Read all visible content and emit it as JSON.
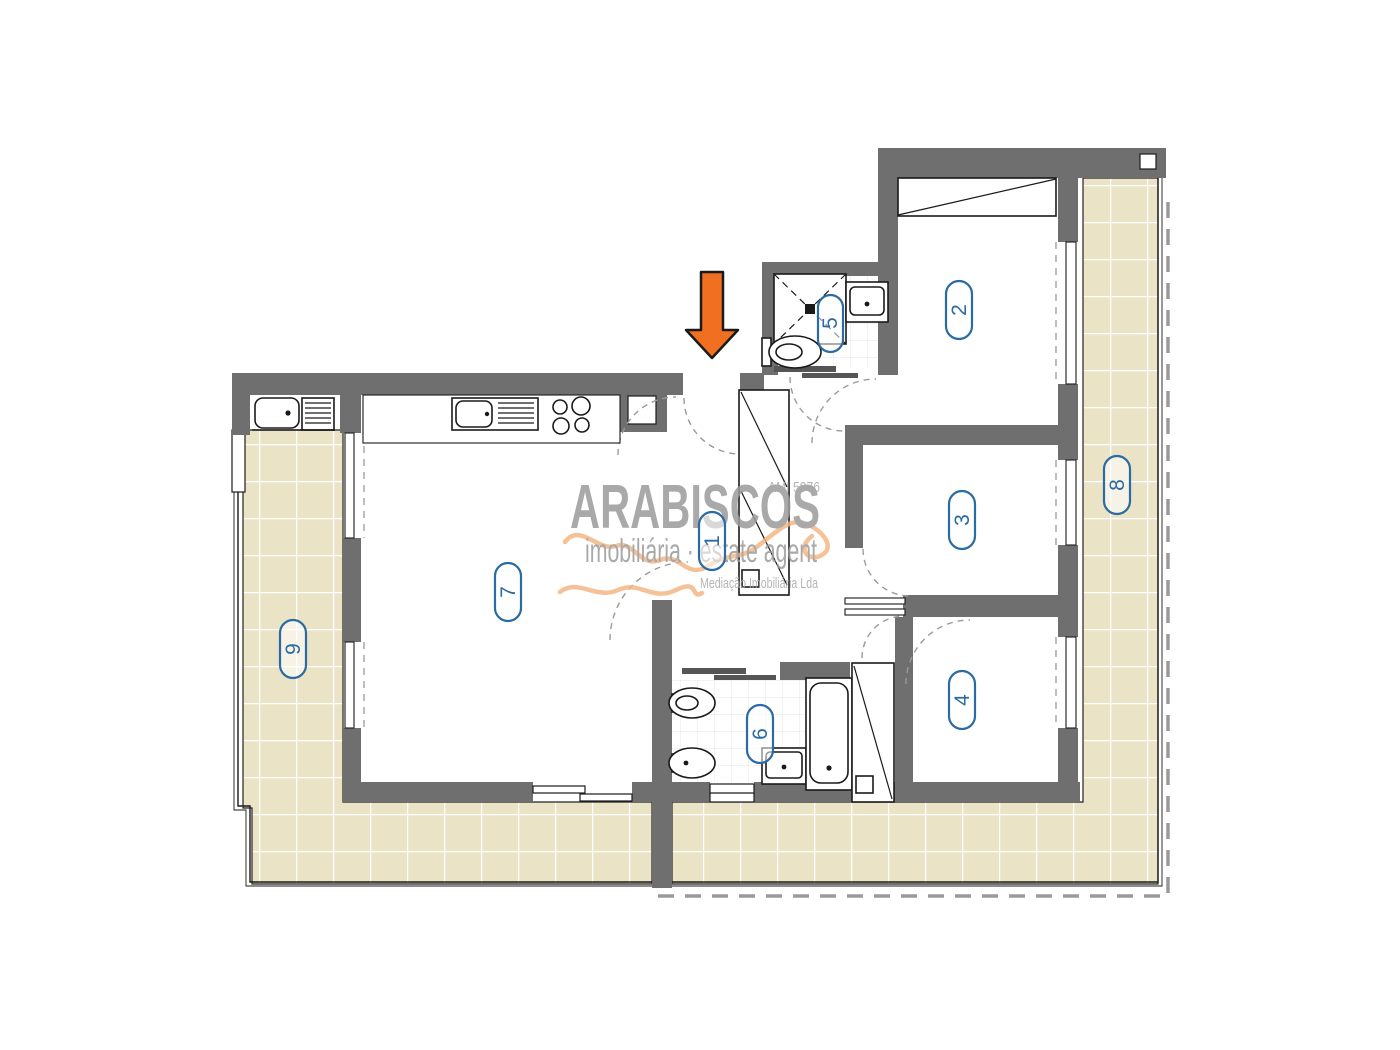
{
  "plan": {
    "type": "apartment floor plan",
    "watermark": {
      "brand": "ARABISCOS",
      "subtitle": "imobiliária · estate agent",
      "tagline": "Mediação Imobiliária Lda",
      "license": "AMI 5976"
    },
    "rooms": [
      {
        "id": "hall",
        "label": "1"
      },
      {
        "id": "bedroom-2",
        "label": "2"
      },
      {
        "id": "bedroom-3",
        "label": "3"
      },
      {
        "id": "bedroom-4",
        "label": "4"
      },
      {
        "id": "bathroom-5",
        "label": "5"
      },
      {
        "id": "bathroom-6",
        "label": "6"
      },
      {
        "id": "living-kitchen",
        "label": "7"
      },
      {
        "id": "terrace-right",
        "label": "8"
      },
      {
        "id": "terrace-left",
        "label": "9"
      }
    ]
  },
  "colors": {
    "wall": "#6f6f6f",
    "tile": "#ebe3c5",
    "grout": "#ffffff",
    "label_blue": "#2a6ba3",
    "arrow_orange": "#f06f21",
    "watermark_gray": "#9b9b9b",
    "squiggle_orange": "#f2b37f"
  }
}
